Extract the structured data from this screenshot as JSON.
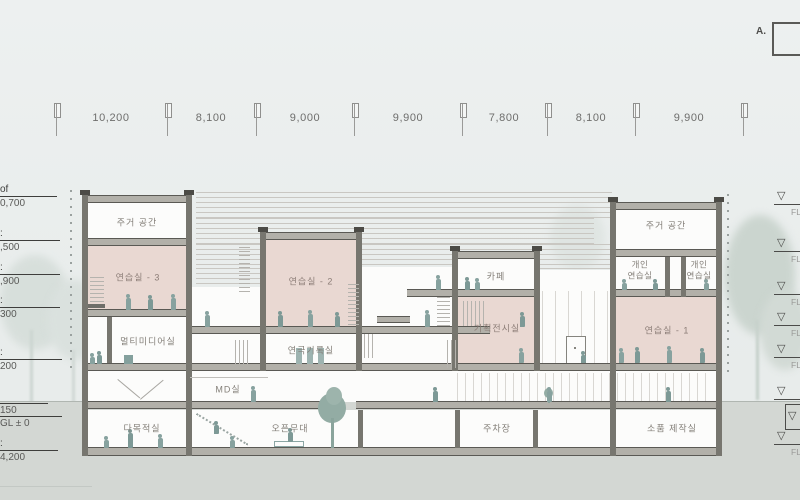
{
  "dimensions": {
    "values": [
      "10,200",
      "8,100",
      "9,000",
      "9,900",
      "7,800",
      "8,100",
      "9,900"
    ]
  },
  "detail_box": {
    "label": "A."
  },
  "levels": {
    "left": [
      {
        "name": "of",
        "value": "0,700"
      },
      {
        "name": ":",
        "value": ",500"
      },
      {
        "name": ":",
        "value": ",900"
      },
      {
        "name": ":",
        "value": "300"
      },
      {
        "name": ":",
        "value": "200"
      },
      {
        "value": "150"
      },
      {
        "value": "GL ± 0"
      },
      {
        "name": ":",
        "value": "4,200"
      }
    ],
    "right": {
      "symbol": "▽",
      "label": "FL"
    }
  },
  "rooms": {
    "housing_left": "주거 공간",
    "practice3": "연습실 - 3",
    "multimedia": "멀티미디어실",
    "practice2": "연습실 - 2",
    "theater_archive": "연극기록실",
    "cafe": "카페",
    "exhibition": "기획전시실",
    "housing_right": "주거 공간",
    "personal_practice_a": "개인\n연습실",
    "personal_practice_b": "개인\n연습실",
    "practice1": "연습실 - 1",
    "md_room": "MD실",
    "multipurpose": "다목적실",
    "open_stage": "오픈무대",
    "parking": "주차장",
    "prop_workshop": "소품 제작실"
  }
}
